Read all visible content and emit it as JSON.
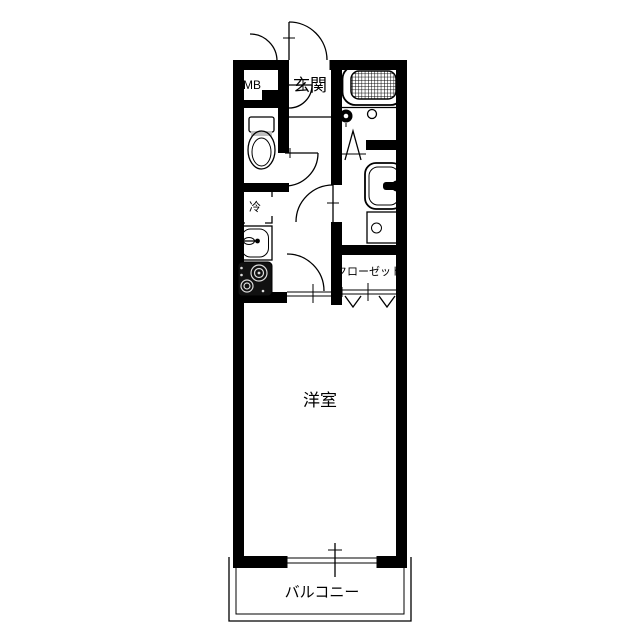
{
  "plan": {
    "labels": {
      "meter_box": "MB",
      "entrance": "玄関",
      "refrigerator_space": "冷",
      "closet": "クローゼット",
      "western_room": "洋室",
      "balcony": "バルコニー"
    },
    "colors": {
      "wall": "#000000",
      "background": "#ffffff",
      "line": "#000000"
    },
    "fixtures": {
      "bathtub": "bathtub-icon",
      "bath_faucet": "faucet-icon",
      "bath_drain": "drain-icon",
      "toilet": "toilet-icon",
      "kitchen_sink": "kitchen-sink-icon",
      "gas_stove": "gas-stove-icon",
      "washbasin": "washbasin-icon",
      "washing_machine_pan": "washing-machine-pan-icon"
    }
  }
}
